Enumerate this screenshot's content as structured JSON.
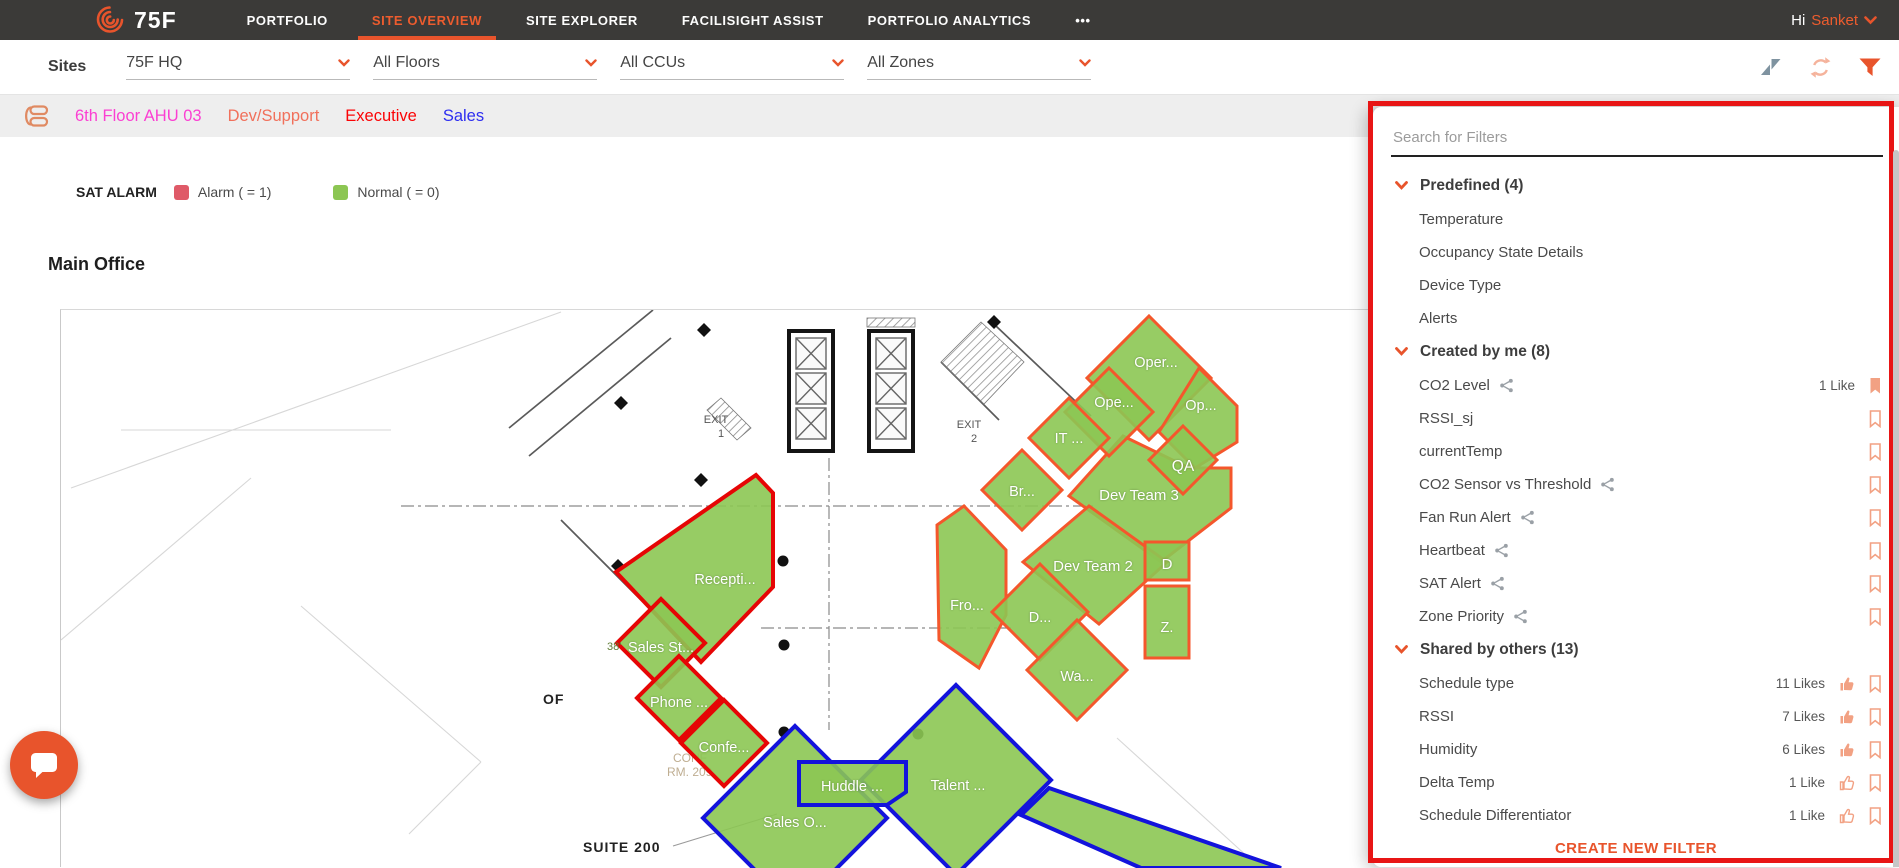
{
  "nav": {
    "brand": "75F",
    "items": [
      {
        "key": "portfolio",
        "label": "PORTFOLIO",
        "active": false
      },
      {
        "key": "site-overview",
        "label": "SITE OVERVIEW",
        "active": true
      },
      {
        "key": "site-explorer",
        "label": "SITE EXPLORER",
        "active": false
      },
      {
        "key": "facilisight-assist",
        "label": "FACILISIGHT ASSIST",
        "active": false
      },
      {
        "key": "portfolio-analytics",
        "label": "PORTFOLIO ANALYTICS",
        "active": false
      },
      {
        "key": "more",
        "label": "•••",
        "active": false
      }
    ],
    "greeting": "Hi",
    "user": "Sanket"
  },
  "filter_bar": {
    "label": "Sites",
    "dropdowns": [
      {
        "key": "site",
        "value": "75F HQ"
      },
      {
        "key": "floors",
        "value": "All Floors"
      },
      {
        "key": "ccus",
        "value": "All CCUs"
      },
      {
        "key": "zones",
        "value": "All Zones"
      }
    ],
    "icons": [
      "zendesk-icon",
      "refresh-icon",
      "filter-funnel-icon"
    ]
  },
  "breadcrumb": {
    "items": [
      {
        "key": "6th-floor-ahu-03",
        "label": "6th Floor AHU 03",
        "color": "#fb3fd2"
      },
      {
        "key": "dev-support",
        "label": "Dev/Support",
        "color": "#f1705b"
      },
      {
        "key": "executive",
        "label": "Executive",
        "color": "#fb0406"
      },
      {
        "key": "sales",
        "label": "Sales",
        "color": "#2e2ef0"
      }
    ]
  },
  "legend": {
    "title": "SAT ALARM",
    "items": [
      {
        "label": "Alarm ( = 1)",
        "color": "#df5a68"
      },
      {
        "label": "Normal ( = 0)",
        "color": "#8cc653"
      }
    ]
  },
  "floorplan": {
    "title": "Main Office",
    "plan_texts": {
      "exit1": "EXIT",
      "exit1_no": "1",
      "exit2": "EXIT",
      "exit2_no": "2",
      "suite": "SUITE 200",
      "conf_line1": "CONF",
      "conf_line2": "RM. 209",
      "dim": "38'",
      "of": "OF"
    },
    "zone_labels": {
      "oper": "Oper...",
      "ope": "Ope...",
      "op": "Op...",
      "it": "IT ...",
      "qa": "QA",
      "br": "Br...",
      "dev3": "Dev Team 3",
      "dev2": "Dev Team 2",
      "d": "D",
      "fro": "Fro...",
      "d2": "D...",
      "z": "Z.",
      "wa": "Wa...",
      "recepti": "Recepti...",
      "sales_st": "Sales St...",
      "phone": "Phone ...",
      "confe": "Confe...",
      "sales_o": "Sales O...",
      "huddle": "Huddle ...",
      "talent": "Talent ..."
    },
    "zone_status_colors": {
      "alarm_red": "#e60505",
      "normal_orange": "#f4572c",
      "selected_blue": "#1313dc",
      "fill_green": "#8cc653"
    }
  },
  "filter_panel": {
    "search_placeholder": "Search for Filters",
    "sections": [
      {
        "key": "predefined",
        "header": "Predefined (4)",
        "items": [
          {
            "name": "Temperature"
          },
          {
            "name": "Occupancy State Details"
          },
          {
            "name": "Device Type"
          },
          {
            "name": "Alerts"
          }
        ]
      },
      {
        "key": "created-by-me",
        "header": "Created by me (8)",
        "items": [
          {
            "name": "CO2 Level",
            "shared": true,
            "likes": "1 Like",
            "bookmark": "filled"
          },
          {
            "name": "RSSI_sj",
            "bookmark": "outline"
          },
          {
            "name": "currentTemp",
            "bookmark": "outline"
          },
          {
            "name": "CO2 Sensor vs Threshold",
            "shared": true,
            "bookmark": "outline"
          },
          {
            "name": "Fan Run Alert",
            "shared": true,
            "bookmark": "outline"
          },
          {
            "name": "Heartbeat",
            "shared": true,
            "bookmark": "outline"
          },
          {
            "name": "SAT Alert",
            "shared": true,
            "bookmark": "outline"
          },
          {
            "name": "Zone Priority",
            "shared": true,
            "bookmark": "outline"
          }
        ]
      },
      {
        "key": "shared-by-others",
        "header": "Shared by others (13)",
        "items": [
          {
            "name": "Schedule type",
            "likes": "11 Likes",
            "thumb": "filled",
            "bookmark": "outline"
          },
          {
            "name": "RSSI",
            "likes": "7 Likes",
            "thumb": "filled",
            "bookmark": "outline"
          },
          {
            "name": "Humidity",
            "likes": "6 Likes",
            "thumb": "filled",
            "bookmark": "outline"
          },
          {
            "name": "Delta Temp",
            "likes": "1 Like",
            "thumb": "outline",
            "bookmark": "outline"
          },
          {
            "name": "Schedule Differentiator",
            "likes": "1 Like",
            "thumb": "outline",
            "bookmark": "outline"
          }
        ]
      }
    ],
    "create_button": "CREATE NEW FILTER"
  },
  "colors": {
    "accent_orange": "#e8542c",
    "nav_bg": "#3b3a38",
    "salmon_icon": "#f2a183",
    "annotation_red": "#e81515",
    "share_gray": "#9aa0a6"
  }
}
